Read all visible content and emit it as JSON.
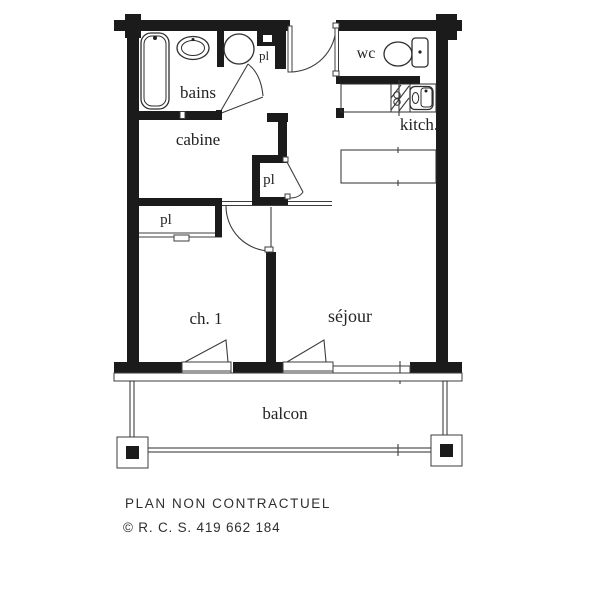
{
  "plan": {
    "rooms": {
      "bains": "bains",
      "closet_top": "pl",
      "wc": "wc",
      "kitchen": "kitch.",
      "cabine": "cabine",
      "closet_mid": "pl",
      "closet_low": "pl",
      "bedroom": "ch. 1",
      "living": "séjour",
      "balcony": "balcon"
    },
    "footer": {
      "disclaimer": "PLAN NON CONTRACTUEL",
      "copyright": "© R. C. S. 419 662 184"
    },
    "colors": {
      "wall": "#1b1b1b",
      "line": "#3c3c3c",
      "background": "#ffffff"
    }
  }
}
